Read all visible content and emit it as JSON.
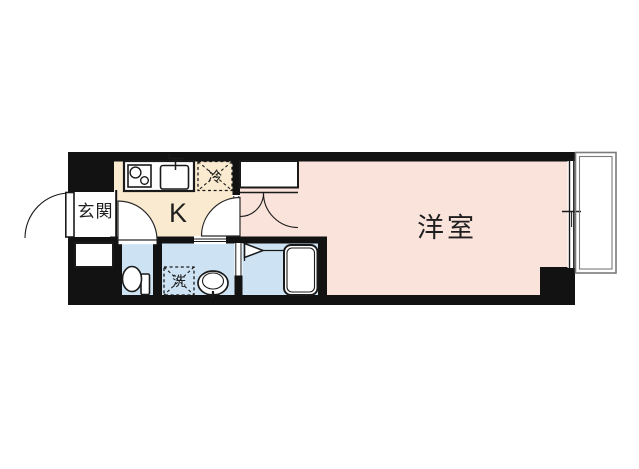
{
  "floorplan": {
    "rooms": {
      "entrance": {
        "label": "玄関"
      },
      "kitchen": {
        "label": "K"
      },
      "western_room": {
        "label": "洋室"
      }
    },
    "fixtures": {
      "refrigerator": {
        "label": "冷"
      },
      "washing_machine": {
        "label": "洗"
      }
    },
    "icons": [
      "entrance-door-icon",
      "shoe-cabinet-icon",
      "stove-icon",
      "kitchen-sink-icon",
      "refrigerator-box",
      "closet-double-door-icon",
      "toilet-icon",
      "washing-machine-box",
      "wash-basin-icon",
      "bathtub-icon",
      "folding-door-icon",
      "sliding-window-icon",
      "balcony-railing"
    ],
    "colors": {
      "wall": "#121212",
      "kitchen_floor": "#faebd0",
      "western_room_floor": "#fae3db",
      "wet_area_floor": "#cde3f3",
      "balcony_line": "#7b7b7b",
      "text": "#1f1f1f"
    }
  }
}
